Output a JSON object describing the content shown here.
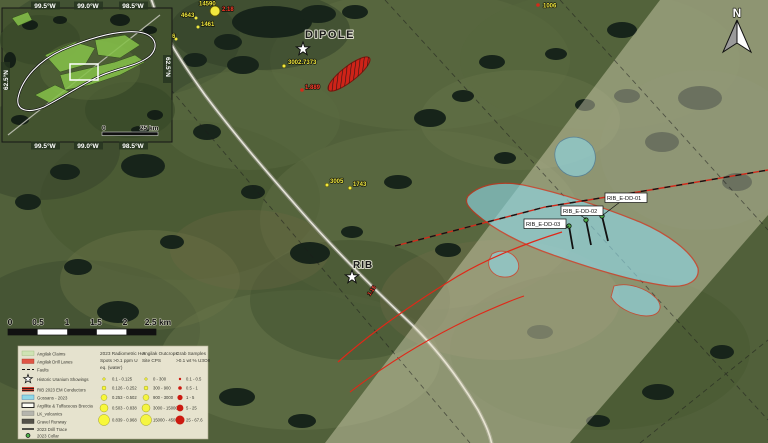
{
  "map": {
    "north_label": "N",
    "targets": {
      "dipole": "DIPOLE",
      "rib": "RIB"
    },
    "drill_holes": [
      "RIB_E-DD-01",
      "RIB_E-DD-02",
      "RIB_E-DD-03"
    ],
    "sample_labels": {
      "yellow": [
        "14590",
        "4643",
        "1461",
        "1266",
        "3002.7373",
        "3005",
        "1743",
        "1006"
      ],
      "red": [
        "2.18",
        "1.889",
        "1.15"
      ]
    },
    "colors": {
      "gossan_cyan": "#8fd9e8",
      "marker_red": "#d42a1a",
      "marker_yellow": "#f2e93e",
      "legend_bg": "#f2edda"
    }
  },
  "inset": {
    "lon_labels": [
      "99.5°W",
      "99.0°W",
      "98.5°W"
    ],
    "lat_label": "62.5°N",
    "scale": {
      "zero": "0",
      "max": "25 km"
    }
  },
  "scalebar": {
    "ticks": [
      "0",
      "0.5",
      "1",
      "1.5",
      "2",
      "2.5 km"
    ]
  },
  "legend": {
    "items": [
      {
        "label": "Angilak Claims"
      },
      {
        "label": "Angilak Drill Lanes"
      },
      {
        "label": "Faults"
      },
      {
        "label": "Historic Uranium Showings"
      },
      {
        "label": "RIB 2023 EM Conductors"
      },
      {
        "label": "Gossans - 2023"
      },
      {
        "label": "Argillite & Tuffaceous Breccia"
      },
      {
        "label": "LK_volcanics"
      },
      {
        "label": "Gravel Runway"
      },
      {
        "label": "2023 Drill Trace"
      },
      {
        "label": "2023 Collar"
      }
    ],
    "hotspots": {
      "title1": "2023 Radiometric Hot",
      "title2": "Spots >0.1 ppm U",
      "title3": "eq. (water)",
      "rows": [
        "0.1 - 0.125",
        "0.126 - 0.252",
        "0.253 - 0.502",
        "0.503 - 0.838",
        "0.839 - 0.968"
      ]
    },
    "cps": {
      "title1": "Angilak Outcrops",
      "title2": "Site CPS",
      "rows": [
        "0 - 300",
        "300 - 900",
        "900 - 3000",
        "3000 - 15000",
        "15000 - 45000"
      ]
    },
    "grab": {
      "title1": "Grab Samples",
      "title2": ">0.1 wt % U3O8",
      "rows": [
        "0.1 - 0.5",
        "0.5 - 1",
        "1 - 5",
        "5 - 25",
        "25 - 67.6"
      ]
    }
  }
}
